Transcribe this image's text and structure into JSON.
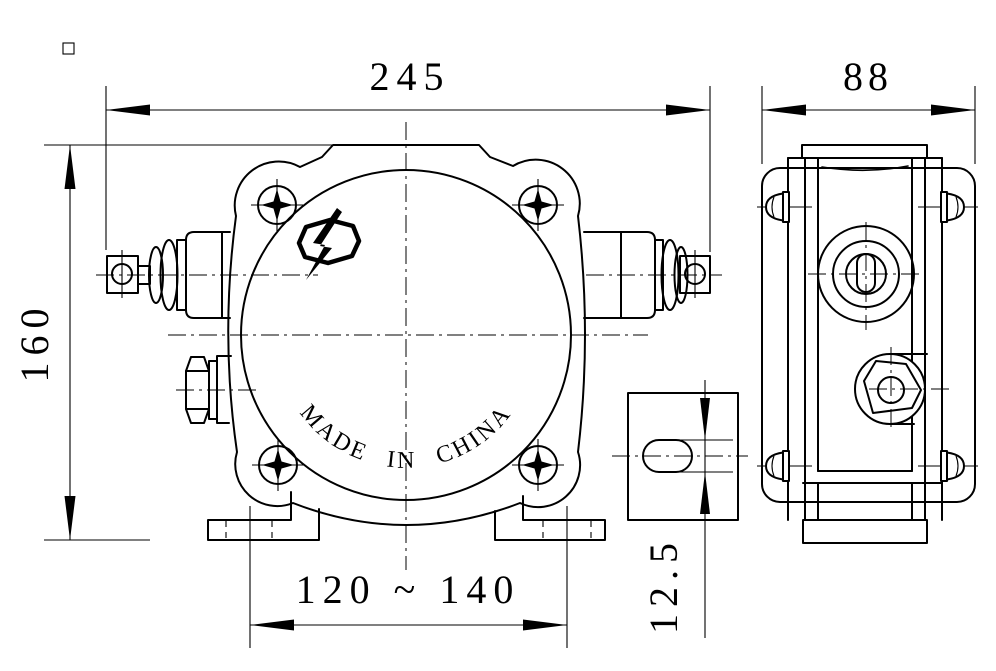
{
  "page": {
    "background": "#ffffff",
    "line_color": "#000000"
  },
  "drawing": {
    "brand_arc_text": "MADE IN CHINA",
    "dimensions": {
      "overall_width": "245",
      "overall_depth": "88",
      "overall_height": "160",
      "mounting_span": "120 ~ 140",
      "slot_width": "12.5"
    }
  }
}
